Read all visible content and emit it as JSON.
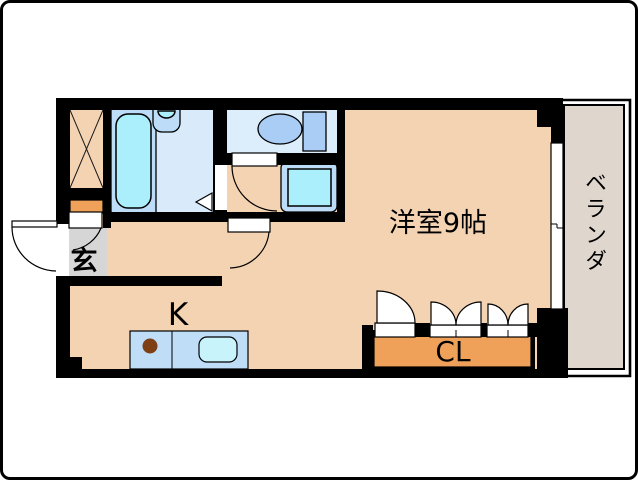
{
  "rooms": {
    "main_room": {
      "label": "洋室9帖"
    },
    "kitchen": {
      "label": "K"
    },
    "closet": {
      "label": "CL"
    },
    "balcony": {
      "label": "ベランダ"
    },
    "entrance": {
      "label": "玄"
    }
  },
  "fixture_icons": [
    "bathtub-icon",
    "washbasin-icon",
    "toilet-icon",
    "washing-machine-pan-icon",
    "kitchen-sink-icon",
    "stove-burner-icon",
    "shoe-cabinet-icon",
    "pipe-space-hatch-icon",
    "sliding-window-icon",
    "door-swing-arc-icon",
    "folding-door-icon"
  ],
  "colors": {
    "wall": "#000000",
    "floor": "#F4D3B2",
    "closet_fill": "#F0A159",
    "entrance_floor": "#D6D6D6",
    "water_panel": "#BCDCF8",
    "bath_floor": "#D9EAFB",
    "toilet_floor": "#DCEDFC",
    "fixture_cyan": "#AAEFFB",
    "fixture_blue": "#A9CDF4",
    "counter": "#BFDDF7",
    "sink": "#C9F3FB",
    "burner": "#7E3F14",
    "balcony_floor": "#DFD6CD"
  }
}
